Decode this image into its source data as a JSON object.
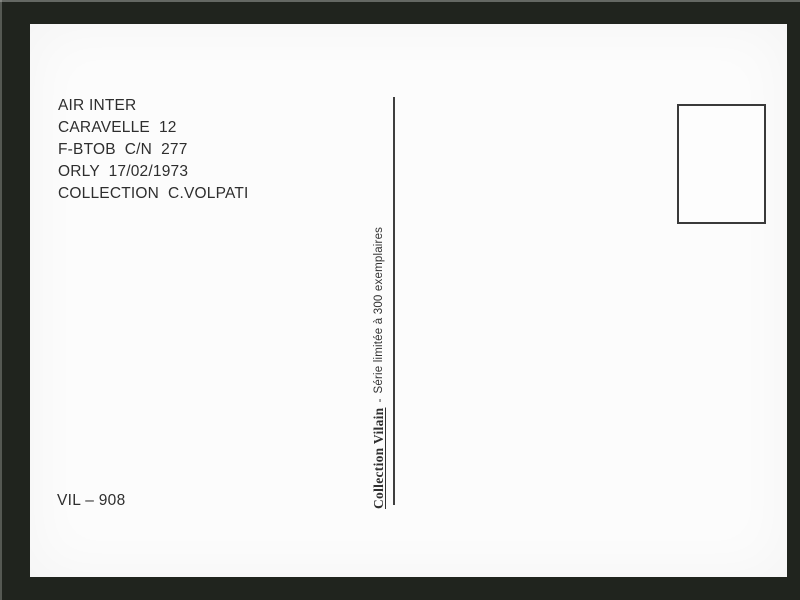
{
  "postcard": {
    "caption": {
      "lines": [
        "AIR INTER",
        "CARAVELLE  12",
        "F-BTOB  C/N  277",
        "ORLY  17/02/1973",
        "COLLECTION  C.VOLPATI"
      ]
    },
    "reference": "VIL – 908",
    "edition": {
      "publisher": "Collection Vilain",
      "separator": "-",
      "limited_note": "Série limitée à 300 exemplaires"
    }
  },
  "colors": {
    "scan_background": "#20241e",
    "card_background": "#fcfcfc",
    "text": "#2e2e2e",
    "divider": "#3f3f3f"
  }
}
